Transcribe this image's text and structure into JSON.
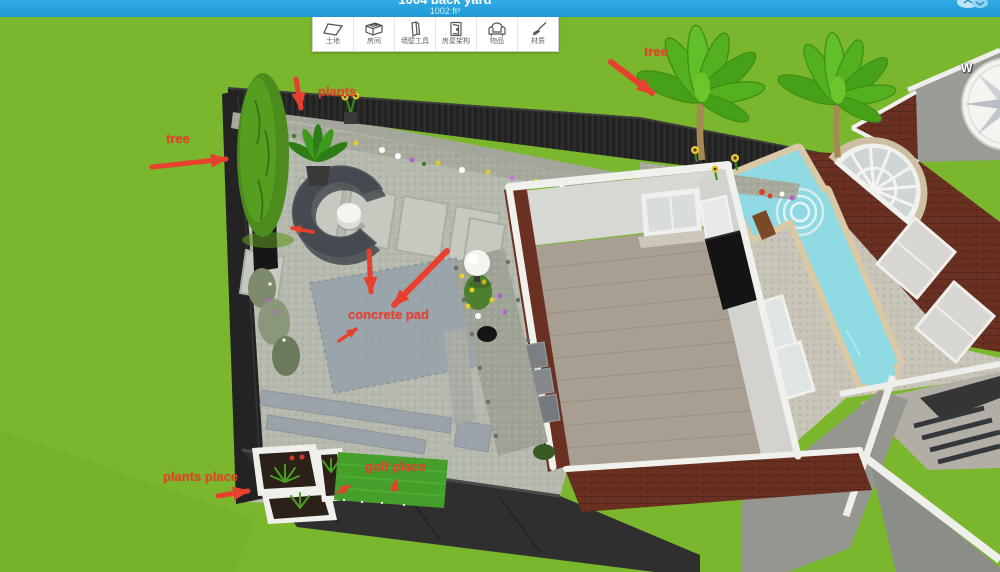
{
  "top_bar": {
    "title": "1004 back yard",
    "area_label": "1002 ft²",
    "cloud_icon": "cloud-icon"
  },
  "toolbar": {
    "items": [
      {
        "label": "土地",
        "icon": "land-icon"
      },
      {
        "label": "房间",
        "icon": "room-icon"
      },
      {
        "label": "墙壁工具",
        "icon": "wall-tools-icon"
      },
      {
        "label": "房屋架构",
        "icon": "house-structure-icon"
      },
      {
        "label": "物品",
        "icon": "items-icon"
      },
      {
        "label": "材质",
        "icon": "materials-icon"
      }
    ]
  },
  "compass": {
    "west_label": "W"
  },
  "annotations": {
    "color": "#e8402e",
    "tree_left": "tree",
    "plants": "plants",
    "tree_right": "tree",
    "concrete_pad": "concrete pad",
    "plants_place": "plants place",
    "golf_place": "golf place"
  },
  "scene": {
    "colors": {
      "lawn": "#7ab72c",
      "fence": "#262626",
      "patio_gravel": "#b6b9ae",
      "paver": "#c5c9c0",
      "concrete_pad": "#9aa4ab",
      "brick": "#6a3122",
      "wall_trim": "#f0f0ec",
      "interior_wall": "#d7d7d3",
      "floor": "#a89e91",
      "pool_water": "#8fd9e3",
      "pool_border": "#d9c9a7",
      "golf_turf": "#44a02a"
    }
  }
}
